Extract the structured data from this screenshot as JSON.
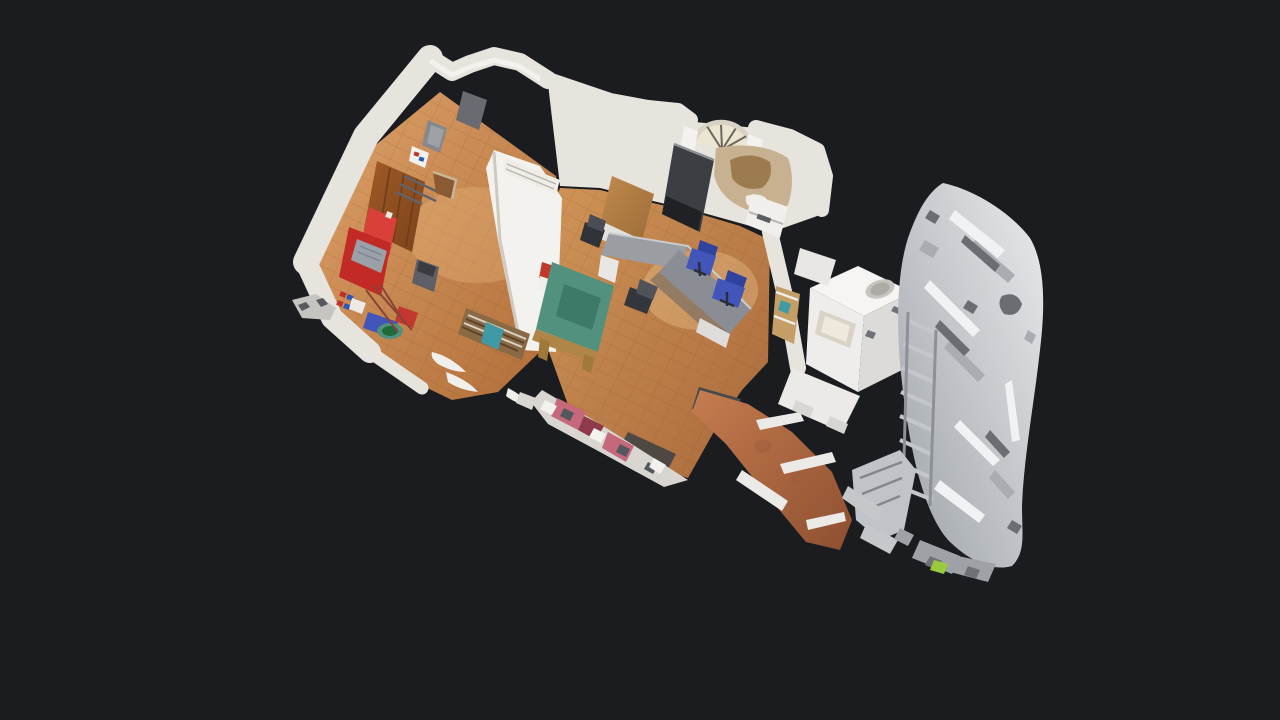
{
  "viewer": {
    "mode": "dollhouse-3d-view",
    "description": "Top-down dollhouse view of a 3D-scanned clinic/office: left room with wooden door, red cabinet and cleaning supplies; middle office with U-shaped gray desk, blue chairs, green table and arched fanlight doorway; right side a partially-scanned fragmented silver volume with white appliance and terracotta hallway.",
    "background_is_empty": true,
    "visible_text": ""
  },
  "palette": {
    "bg": "#1a1c1f",
    "wall": "#e7e3dd",
    "wallBright": "#f4f2ee",
    "wallShade": "#cfc9c1",
    "grout": "#8a5328",
    "floorL1": "#dda268",
    "floorL2": "#b06c38",
    "floorM1": "#d09457",
    "floorM2": "#a9693b",
    "hall1": "#c57c4f",
    "hall2": "#8e4f30",
    "door1": "#a05a26",
    "door2": "#7c431a",
    "doorLine": "#6e3c16",
    "red": "#c22b25",
    "redBright": "#d84038",
    "blue": "#4156b8",
    "blueDark": "#2f429e",
    "green": "#53917f",
    "greenDark": "#3d7a6a",
    "deskTop": "#9a9da2",
    "deskTop2": "#8a8d93",
    "deskEdge": "#c9ccd0",
    "darkCab": "#3b3e43",
    "charcoal": "#1f2125",
    "binGray": "#5c6066",
    "binDark": "#393c40",
    "cream": "#ece5d2",
    "archFrame": "#d8d2c6",
    "archSpoke": "#6b675e",
    "tanEquip": "#c7b191",
    "tanDark": "#9c7c4e",
    "woodDesk1": "#c08a4e",
    "woodDesk2": "#9c6c36",
    "woodEdge": "#b08648",
    "woodLeg": "#a07838",
    "shelfWood": "#8a6a44",
    "teal": "#3f9aa6",
    "whiteFrag": "#eceae6",
    "silver1": "#e9ebed",
    "silver2": "#9ea3a8",
    "silverLight": "#f1f2f3",
    "silverMid": "#a9adb2",
    "silverDark": "#6a6e73",
    "metalBox": "#9ba1a8",
    "pink": "#c4687a",
    "maroon": "#8e3a4a",
    "matDark": "#45484d",
    "greenShard": "#9acb3c",
    "stickerRed": "#c03028",
    "stickerBlue": "#2858b8",
    "railGray": "#60636a"
  },
  "scene": {
    "objects": [
      {
        "id": "left-room",
        "label": "utility room with wooden floor"
      },
      {
        "id": "entry-door",
        "label": "brown wooden door"
      },
      {
        "id": "red-cabinet",
        "label": "red fire-equipment cabinet"
      },
      {
        "id": "trash-bin",
        "label": "gray waste bin"
      },
      {
        "id": "cleaning-supplies",
        "label": "mop, green bucket, blue tarp, red bucket"
      },
      {
        "id": "middle-office",
        "label": "office with tiled wooden floor"
      },
      {
        "id": "arch-fanlight",
        "label": "arched fanlight above doorway"
      },
      {
        "id": "dark-cabinet",
        "label": "tall dark gray cabinet"
      },
      {
        "id": "u-desk",
        "label": "gray U-shaped desk"
      },
      {
        "id": "blue-chair-1",
        "label": "blue office chair"
      },
      {
        "id": "blue-chair-2",
        "label": "blue office chair"
      },
      {
        "id": "green-table",
        "label": "green-topped work table"
      },
      {
        "id": "wood-desk",
        "label": "wooden side desk"
      },
      {
        "id": "appliance",
        "label": "white appliance with sink top"
      },
      {
        "id": "hallway",
        "label": "terracotta hallway floor"
      },
      {
        "id": "scan-fragment-volume",
        "label": "fragmented silver scan geometry"
      }
    ]
  }
}
